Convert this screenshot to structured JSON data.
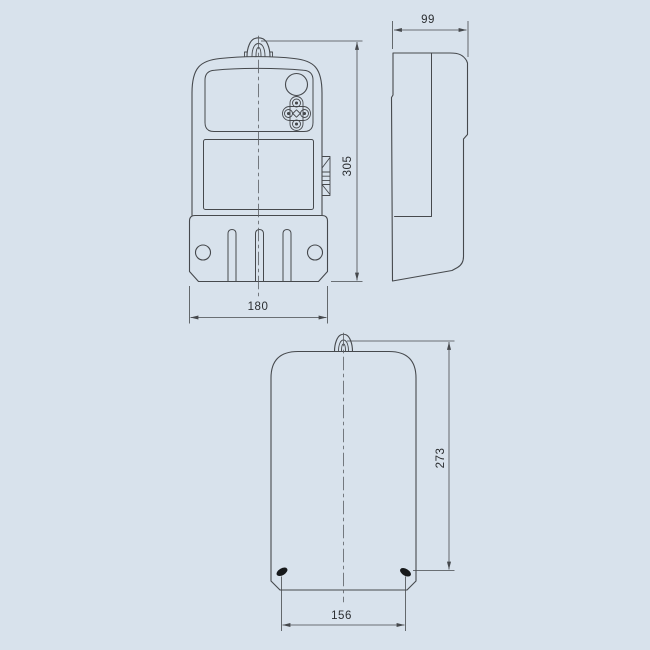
{
  "drawing": {
    "subject": "energy-meter-dimensional-drawing",
    "colors": {
      "background": "#d8e2ec",
      "line": "#46494d",
      "text": "#2b2e31"
    },
    "views": {
      "front": {
        "name": "front view",
        "height_mm": "305",
        "width_mm": "180"
      },
      "side": {
        "name": "side view",
        "depth_mm": "99"
      },
      "back": {
        "name": "back view",
        "height_mm": "273",
        "width_mm": "156"
      }
    }
  }
}
